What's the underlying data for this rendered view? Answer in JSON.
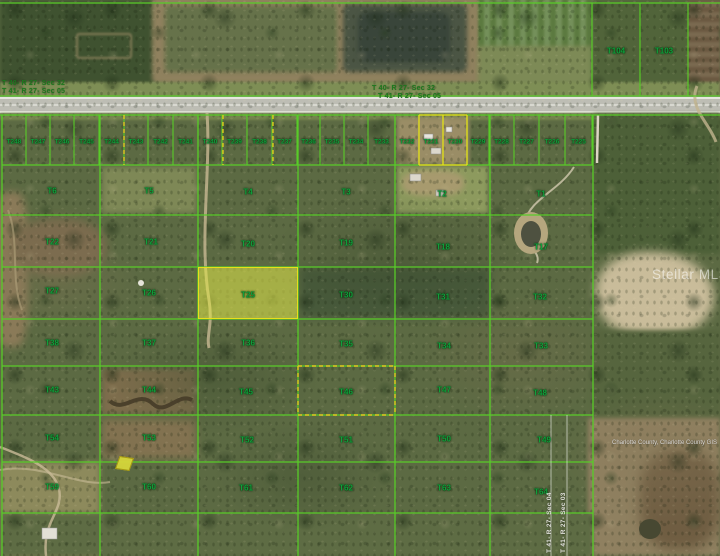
{
  "colors": {
    "grid_green": "#58cc28",
    "label_green": "#0fa03c",
    "dashed_yellow": "#e0c81e",
    "solid_yellow": "#e8df1a",
    "highlight_fill": "rgba(226,232,72,0.55)",
    "white_line": "rgba(255,255,255,0.55)"
  },
  "texts": {
    "section_top_left_1": "T 40- R 27- Sec 32",
    "section_top_left_2": "T 41- R 27- Sec 05",
    "section_top_center_1": "T 40- R 27- Sec 32",
    "section_top_center_2": "T 41- R 27- Sec 05",
    "section_vertical_west": "T 41- R 27- Sec 04",
    "section_vertical_east": "T 41- R 27- Sec 03",
    "watermark": "Stellar MLS",
    "attribution": "Charlotte County, Charlotte County GIS"
  },
  "highlight": {
    "label": "T25",
    "x": 198,
    "y": 267,
    "w": 100,
    "h": 52
  },
  "lots": {
    "label_y": 142,
    "top": 115,
    "bottom": 165,
    "bounds": [
      2,
      26,
      50,
      74,
      99,
      124,
      148,
      173,
      198,
      222,
      247,
      272,
      297,
      320,
      344,
      368,
      395,
      419,
      443,
      467,
      489,
      514,
      539,
      565,
      592
    ],
    "labels": [
      "T248",
      "T247",
      "T246",
      "T245",
      "T244",
      "T243",
      "T242",
      "T241",
      "T240",
      "T239",
      "T238",
      "T237",
      "T236",
      "T235",
      "T234",
      "T233",
      "T232",
      "T231",
      "T230",
      "T229",
      "T228",
      "T227",
      "T226",
      "T225"
    ]
  },
  "parcels": [
    {
      "label": "T6",
      "x": 52,
      "y": 191
    },
    {
      "label": "T5",
      "x": 149,
      "y": 191
    },
    {
      "label": "T4",
      "x": 248,
      "y": 192
    },
    {
      "label": "T3",
      "x": 346,
      "y": 192
    },
    {
      "label": "T2",
      "x": 442,
      "y": 194
    },
    {
      "label": "T1",
      "x": 541,
      "y": 194
    },
    {
      "label": "T22",
      "x": 52,
      "y": 242
    },
    {
      "label": "T21",
      "x": 151,
      "y": 242
    },
    {
      "label": "T20",
      "x": 248,
      "y": 244
    },
    {
      "label": "T19",
      "x": 346,
      "y": 243
    },
    {
      "label": "T18",
      "x": 443,
      "y": 247
    },
    {
      "label": "T17",
      "x": 541,
      "y": 247
    },
    {
      "label": "T27",
      "x": 52,
      "y": 291
    },
    {
      "label": "T26",
      "x": 149,
      "y": 293
    },
    {
      "label": "T25",
      "x": 248,
      "y": 295
    },
    {
      "label": "T30",
      "x": 346,
      "y": 295
    },
    {
      "label": "T31",
      "x": 443,
      "y": 297
    },
    {
      "label": "T32",
      "x": 540,
      "y": 297
    },
    {
      "label": "T38",
      "x": 52,
      "y": 343
    },
    {
      "label": "T37",
      "x": 149,
      "y": 343
    },
    {
      "label": "T36",
      "x": 248,
      "y": 343
    },
    {
      "label": "T35",
      "x": 346,
      "y": 344
    },
    {
      "label": "T34",
      "x": 444,
      "y": 346
    },
    {
      "label": "T33",
      "x": 541,
      "y": 346
    },
    {
      "label": "T43",
      "x": 52,
      "y": 390
    },
    {
      "label": "T44",
      "x": 149,
      "y": 390
    },
    {
      "label": "T45",
      "x": 246,
      "y": 392
    },
    {
      "label": "T46",
      "x": 346,
      "y": 392
    },
    {
      "label": "T47",
      "x": 444,
      "y": 390
    },
    {
      "label": "T48",
      "x": 540,
      "y": 393
    },
    {
      "label": "T54",
      "x": 52,
      "y": 438
    },
    {
      "label": "T53",
      "x": 149,
      "y": 438
    },
    {
      "label": "T52",
      "x": 247,
      "y": 440
    },
    {
      "label": "T51",
      "x": 346,
      "y": 440
    },
    {
      "label": "T50",
      "x": 444,
      "y": 439
    },
    {
      "label": "T49",
      "x": 544,
      "y": 440
    },
    {
      "label": "T59",
      "x": 52,
      "y": 487
    },
    {
      "label": "T60",
      "x": 149,
      "y": 487
    },
    {
      "label": "T61",
      "x": 246,
      "y": 488
    },
    {
      "label": "T62",
      "x": 346,
      "y": 488
    },
    {
      "label": "T63",
      "x": 444,
      "y": 488
    },
    {
      "label": "T64",
      "x": 541,
      "y": 492
    },
    {
      "label": "T104",
      "x": 616,
      "y": 51
    },
    {
      "label": "T103",
      "x": 664,
      "y": 51
    }
  ],
  "grid": {
    "cols": [
      2,
      100,
      198,
      298,
      395,
      490,
      593
    ],
    "rows": [
      165,
      215,
      267,
      319,
      366,
      415,
      462,
      513
    ],
    "col_top": 115,
    "col_bottom": 556,
    "row_left": 2,
    "row_right": 593,
    "full_lines_y": [
      3,
      96,
      115
    ],
    "topright_cols": [
      592,
      640,
      688
    ],
    "topright_top": 3,
    "topright_bottom": 96,
    "dashed_v": [
      124,
      223,
      273
    ],
    "dashed_rect": {
      "x1": 298,
      "y1": 366,
      "x2": 395,
      "y2": 415
    },
    "yellow_rect": {
      "x1": 419,
      "y1": 115,
      "x2": 467,
      "y2": 165
    },
    "yellow_mid_x": 443,
    "white_v": [
      551,
      567
    ],
    "white_v_top": 415,
    "white_v_bottom": 556
  }
}
